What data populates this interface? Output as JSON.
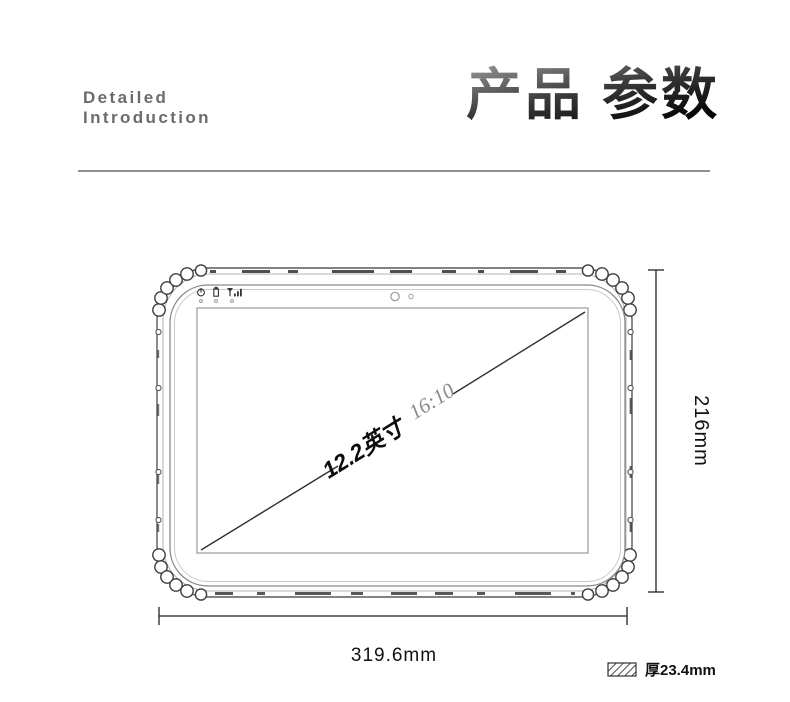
{
  "header": {
    "subtitle_line1": "Detailed",
    "subtitle_line2": "Introduction",
    "title_part1": "产品",
    "title_part2": "参数"
  },
  "diagram": {
    "screen_size_label": "12.2英寸",
    "aspect_ratio_label": "16:10",
    "height_label": "216mm",
    "width_label": "319.6mm",
    "thickness_label": "厚23.4mm",
    "icons": {
      "status_bar": [
        "power-icon",
        "battery-icon",
        "signal-icon"
      ],
      "front": [
        "camera-dot",
        "light-sensor-dot"
      ],
      "legend": "hatched-thickness-swatch"
    }
  },
  "colors": {
    "title_gradient_top": "#9a9a9a",
    "title_gradient_bottom": "#000000",
    "subtitle_gray": "#6b6b6b",
    "divider_gray": "#8f8f8f",
    "sketch_line": "#5a5a5a",
    "dimension_line": "#222222"
  }
}
